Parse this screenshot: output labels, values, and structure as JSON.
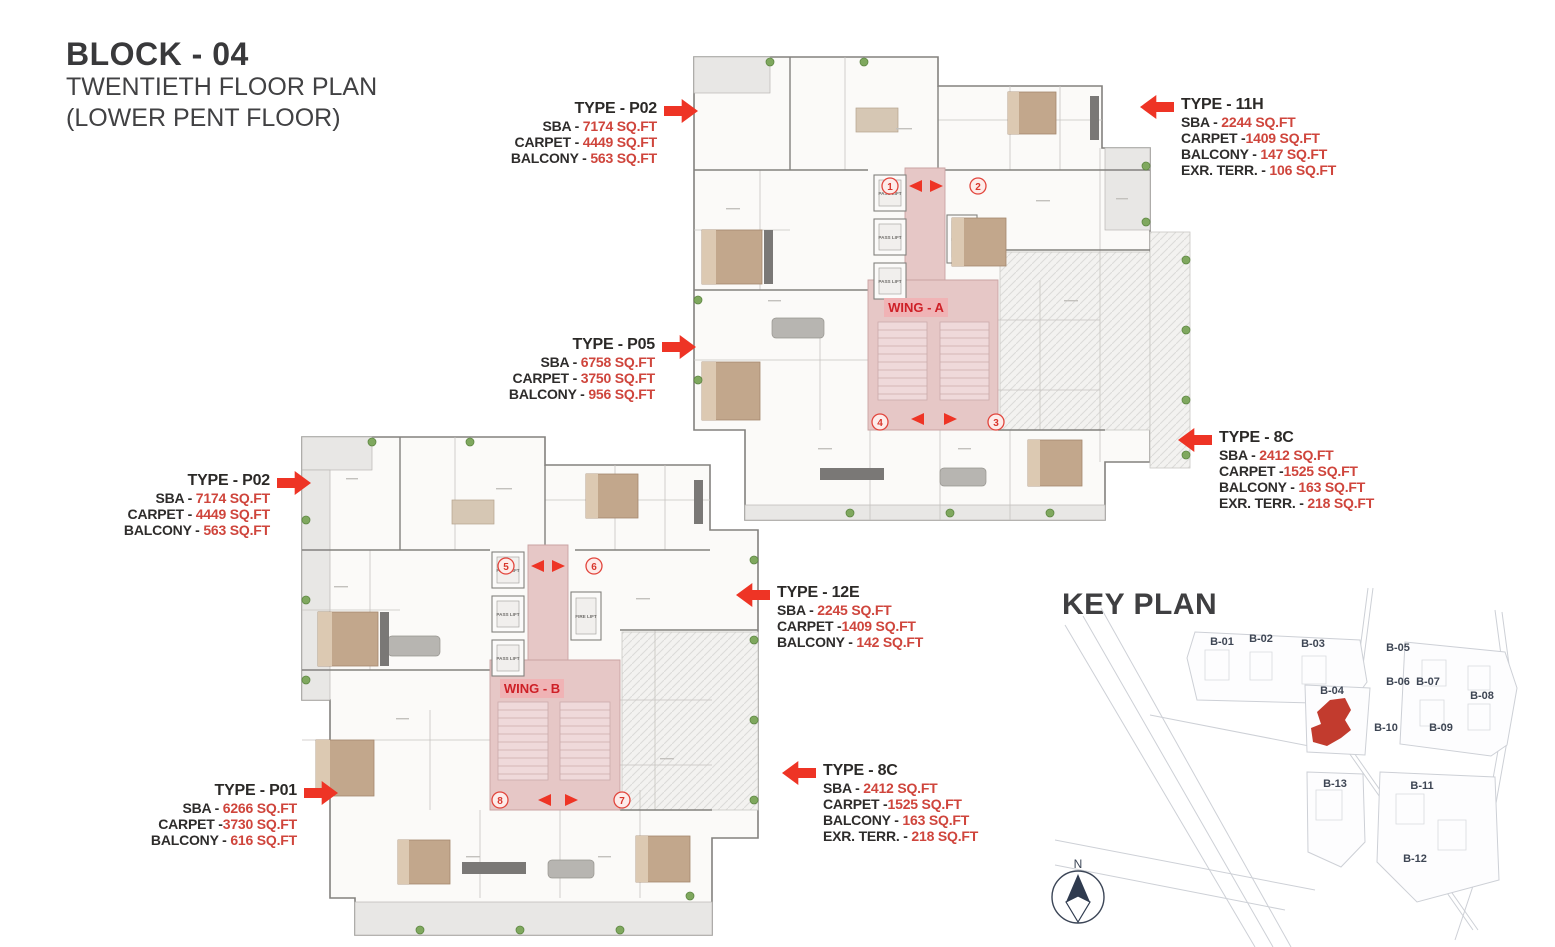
{
  "title": {
    "line1": "BLOCK - 04",
    "line2": "TWENTIETH FLOOR PLAN",
    "line3": "(LOWER PENT FLOOR)"
  },
  "colors": {
    "accent_red": "#ee3425",
    "value_red": "#cf453c",
    "corridor_pink": "#e6c7c6",
    "wing_label_red": "#ce2027",
    "wall_gray": "#83817e",
    "plant_green": "#7fa85e",
    "keyplan_line": "#cdd0d6",
    "keyplan_label": "#3e4654",
    "highlight_red": "#c23b2e"
  },
  "cards": [
    {
      "title": "TYPE - P02",
      "rows": [
        {
          "label": "SBA - ",
          "value": "7174 SQ.FT"
        },
        {
          "label": "CARPET - ",
          "value": "4449 SQ.FT"
        },
        {
          "label": "BALCONY - ",
          "value": "563 SQ.FT"
        }
      ]
    },
    {
      "title": "TYPE - 11H",
      "rows": [
        {
          "label": "SBA - ",
          "value": "2244 SQ.FT"
        },
        {
          "label": "CARPET -",
          "value": "1409 SQ.FT"
        },
        {
          "label": "BALCONY - ",
          "value": "147 SQ.FT"
        },
        {
          "label": "EXR. TERR. - ",
          "value": "106 SQ.FT"
        }
      ]
    },
    {
      "title": "TYPE - P05",
      "rows": [
        {
          "label": "SBA - ",
          "value": "6758 SQ.FT"
        },
        {
          "label": "CARPET - ",
          "value": "3750 SQ.FT"
        },
        {
          "label": "BALCONY - ",
          "value": "956 SQ.FT"
        }
      ]
    },
    {
      "title": "TYPE - 8C",
      "rows": [
        {
          "label": "SBA - ",
          "value": "2412 SQ.FT"
        },
        {
          "label": "CARPET -",
          "value": "1525 SQ.FT"
        },
        {
          "label": "BALCONY - ",
          "value": "163 SQ.FT"
        },
        {
          "label": "EXR. TERR. - ",
          "value": "218 SQ.FT"
        }
      ]
    },
    {
      "title": "TYPE - P02",
      "rows": [
        {
          "label": "SBA - ",
          "value": "7174 SQ.FT"
        },
        {
          "label": "CARPET - ",
          "value": "4449 SQ.FT"
        },
        {
          "label": "BALCONY - ",
          "value": "563 SQ.FT"
        }
      ]
    },
    {
      "title": "TYPE - 12E",
      "rows": [
        {
          "label": "SBA - ",
          "value": "2245 SQ.FT"
        },
        {
          "label": "CARPET -",
          "value": "1409 SQ.FT"
        },
        {
          "label": "BALCONY - ",
          "value": "142 SQ.FT"
        }
      ]
    },
    {
      "title": "TYPE - P01",
      "rows": [
        {
          "label": "SBA - ",
          "value": "6266 SQ.FT"
        },
        {
          "label": "CARPET -",
          "value": "3730 SQ.FT"
        },
        {
          "label": "BALCONY - ",
          "value": "616 SQ.FT"
        }
      ]
    },
    {
      "title": "TYPE - 8C",
      "rows": [
        {
          "label": "SBA - ",
          "value": "2412 SQ.FT"
        },
        {
          "label": "CARPET -",
          "value": "1525 SQ.FT"
        },
        {
          "label": "BALCONY - ",
          "value": "163 SQ.FT"
        },
        {
          "label": "EXR. TERR. - ",
          "value": "218 SQ.FT"
        }
      ]
    }
  ],
  "wings": {
    "a": {
      "label": "WING - A",
      "units": [
        "1",
        "2",
        "3",
        "4"
      ]
    },
    "b": {
      "label": "WING - B",
      "units": [
        "5",
        "6",
        "7",
        "8"
      ]
    }
  },
  "lifts": {
    "pass_label": "PASS LIFT",
    "fire_label": "FIRE LIFT"
  },
  "key_plan": {
    "title": "KEY PLAN",
    "highlight_block": "B-04",
    "blocks": [
      "B-01",
      "B-02",
      "B-03",
      "B-05",
      "B-06",
      "B-07",
      "B-08",
      "B-04",
      "B-10",
      "B-09",
      "B-13",
      "B-11",
      "B-12"
    ]
  },
  "compass": {
    "north": "N"
  }
}
